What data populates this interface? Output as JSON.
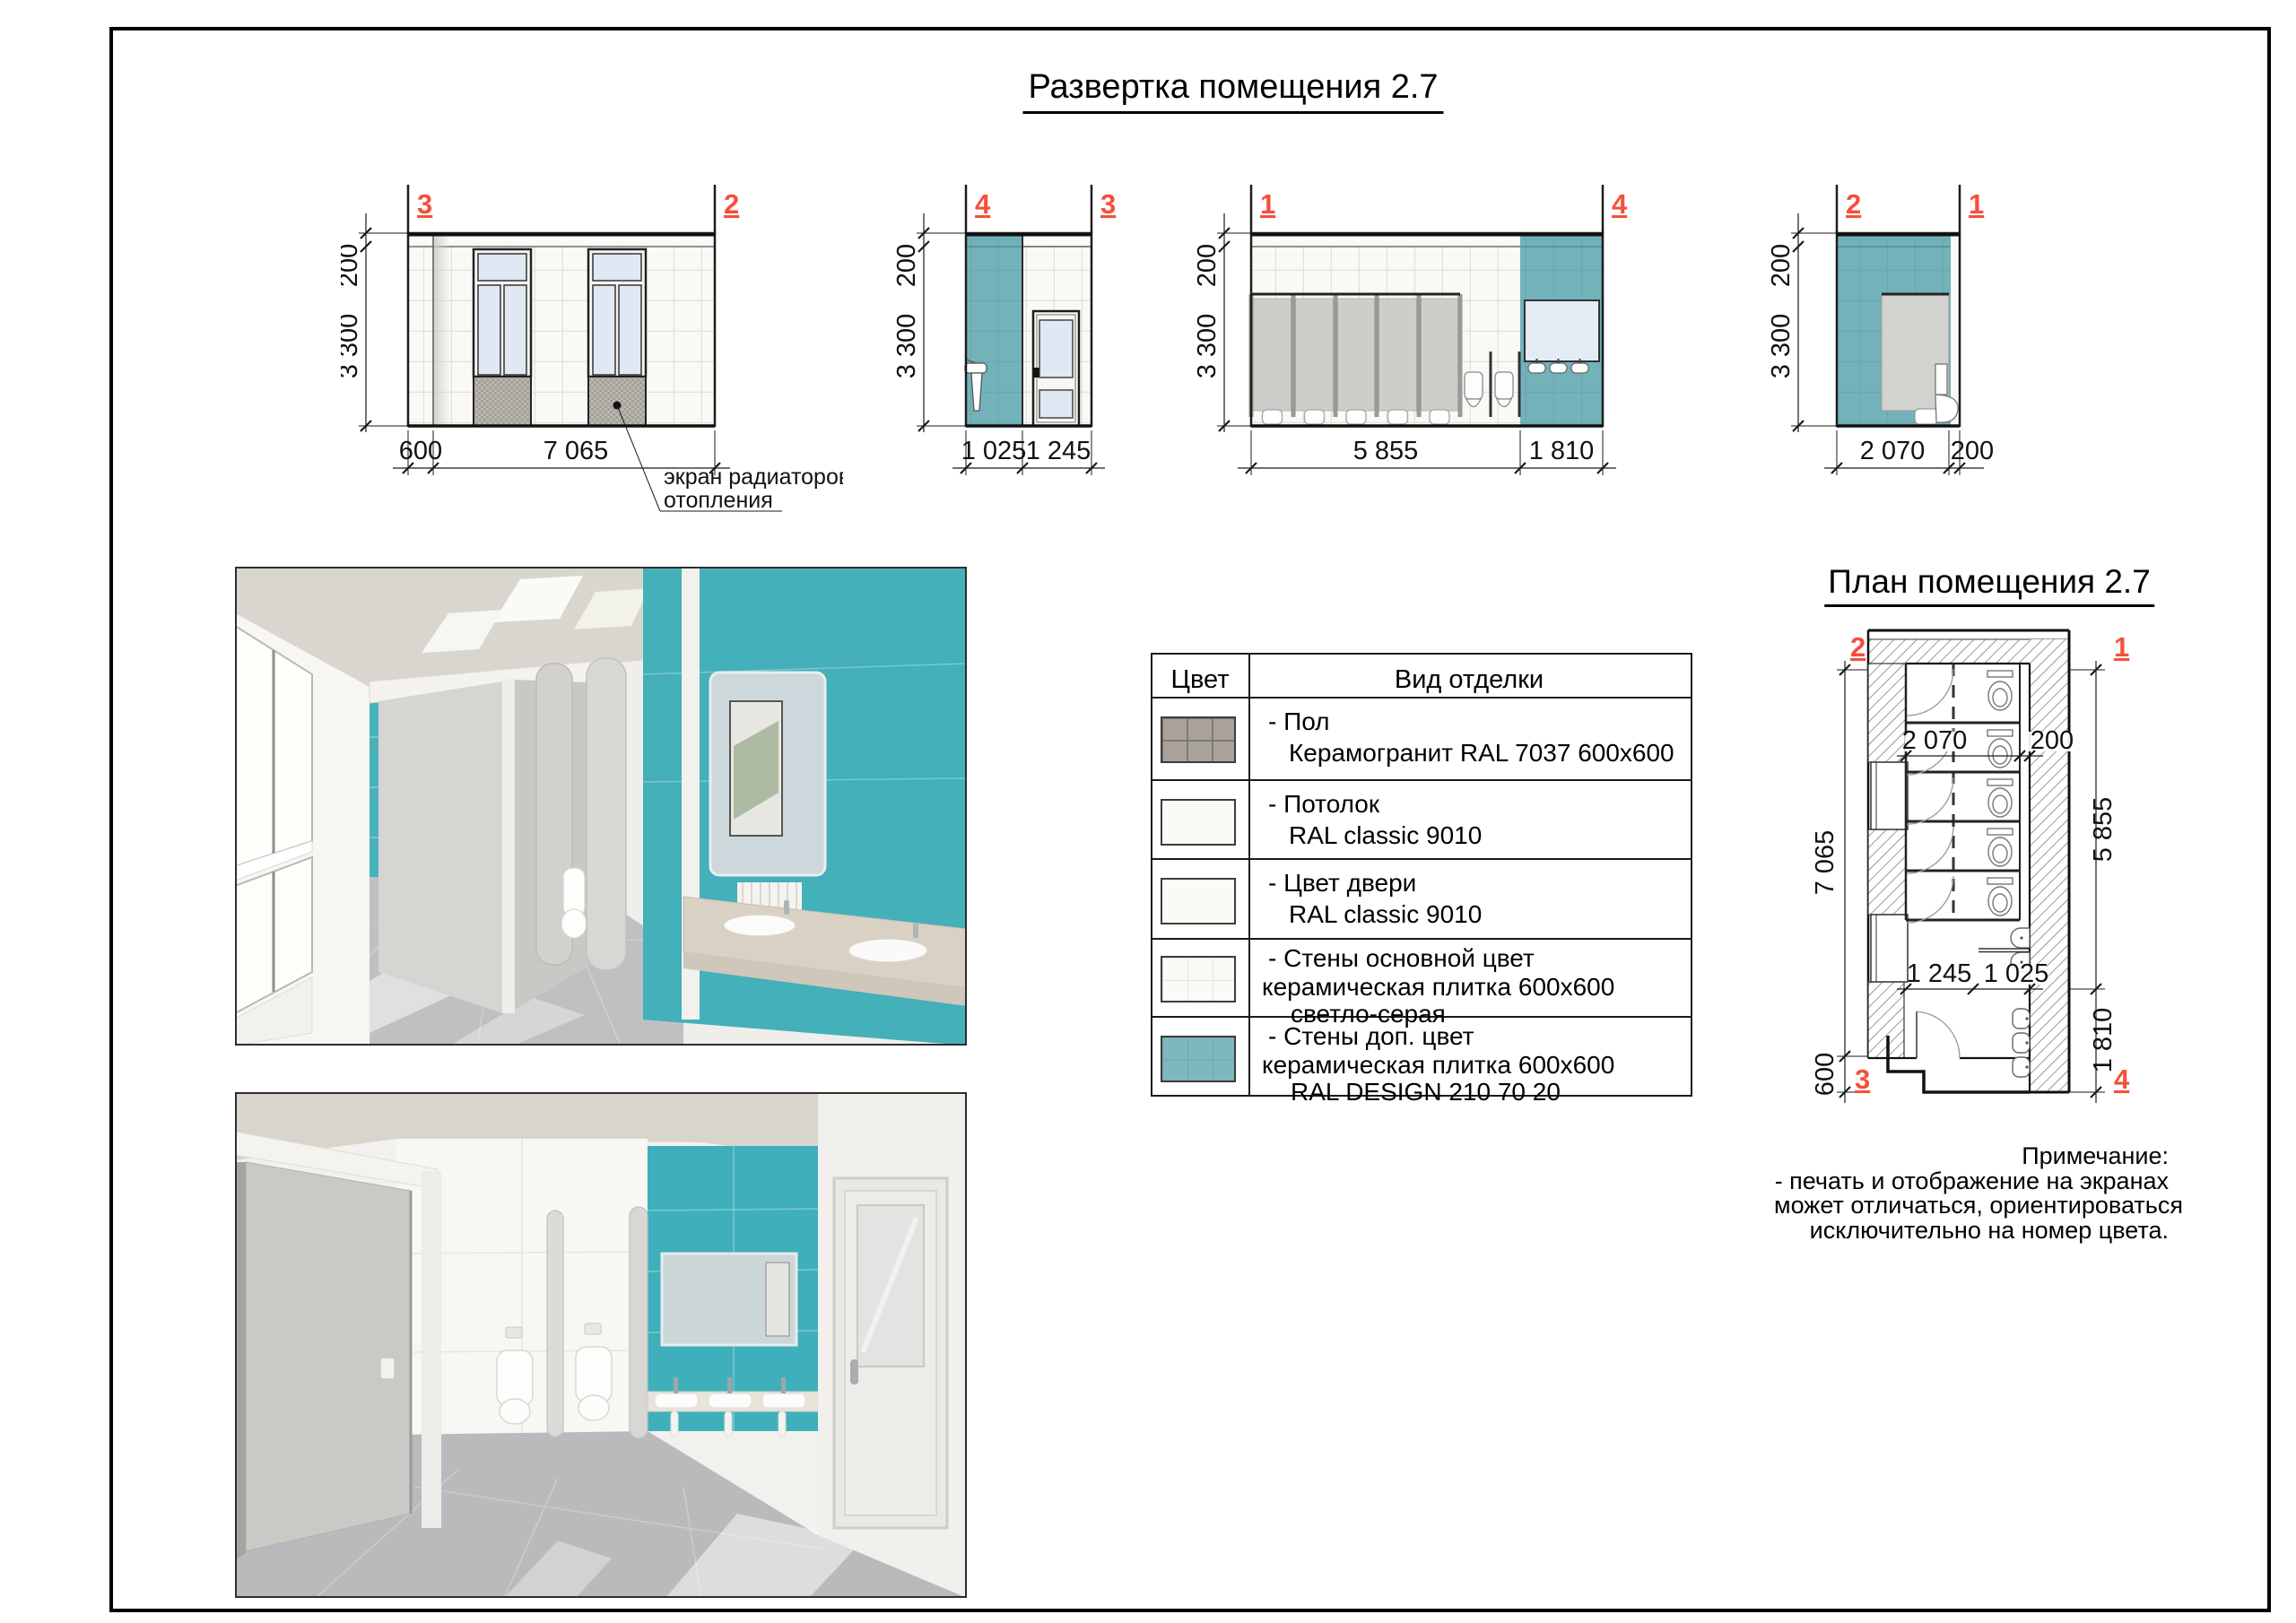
{
  "sheet": {
    "title": "Развертка помещения 2.7"
  },
  "elevations": [
    {
      "name": "wall-3-2",
      "marker_left": "3",
      "marker_right": "2",
      "dim_band": "200",
      "dim_height": "3 300",
      "dim_a": "600",
      "dim_b": "7 065",
      "callout_line1": "экран радиаторов",
      "callout_line2": "отопления"
    },
    {
      "name": "wall-4-3",
      "marker_left": "4",
      "marker_right": "3",
      "dim_band": "200",
      "dim_height": "3 300",
      "dim_a": "1 025",
      "dim_b": "1 245"
    },
    {
      "name": "wall-1-4",
      "marker_left": "1",
      "marker_right": "4",
      "dim_band": "200",
      "dim_height": "3 300",
      "dim_a": "5 855",
      "dim_b": "1 810"
    },
    {
      "name": "wall-2-1",
      "marker_left": "2",
      "marker_right": "1",
      "dim_band": "200",
      "dim_height": "3 300",
      "dim_a": "2 070",
      "dim_b": "200"
    }
  ],
  "finish_table": {
    "header_color": "Цвет",
    "header_finish": "Вид отделки",
    "rows": [
      {
        "swatch": "floor-tile-gray",
        "lines": [
          "- Пол",
          "Керамогранит RAL 7037 600x600"
        ]
      },
      {
        "swatch": "plain-white",
        "lines": [
          "- Потолок",
          "RAL classic 9010"
        ]
      },
      {
        "swatch": "plain-white",
        "lines": [
          "- Цвет двери",
          "RAL classic 9010"
        ]
      },
      {
        "swatch": "tile-light-gray",
        "lines": [
          "- Стены основной цвет",
          "керамическая плитка 600x600",
          "светло-серая"
        ]
      },
      {
        "swatch": "tile-teal",
        "lines": [
          "- Стены доп. цвет",
          "керамическая плитка 600x600",
          "RAL DESIGN 210 70 20"
        ]
      }
    ]
  },
  "plan": {
    "title": "План помещения 2.7",
    "marker_top_left": "2",
    "marker_top_right": "1",
    "marker_bottom_left": "3",
    "marker_bottom_right": "4",
    "dim_left": "7 065",
    "dim_left_small": "600",
    "dim_right": "5 855",
    "dim_right_small": "1 810",
    "dim_inner_top_a": "2 070",
    "dim_inner_top_b": "200",
    "dim_inner_bottom_a": "1 245",
    "dim_inner_bottom_b": "1 025"
  },
  "note": {
    "heading": "Примечание:",
    "line1": "- печать и отображение на экранах",
    "line2": "может отличаться, ориентироваться",
    "line3": "исключительно на номер цвета."
  },
  "colors": {
    "marker_red": "#f4503c",
    "teal_wall_elevation": "#74b2ba",
    "teal_wall_render": "#3fb0bb",
    "tile_offwhite": "#faf9f5",
    "glass_blue": "#dfe8f3",
    "stall_gray": "#cfcfcd",
    "radiator_gray": "#b9b6b0",
    "floor_swatch_gray": "#a8a29b"
  }
}
